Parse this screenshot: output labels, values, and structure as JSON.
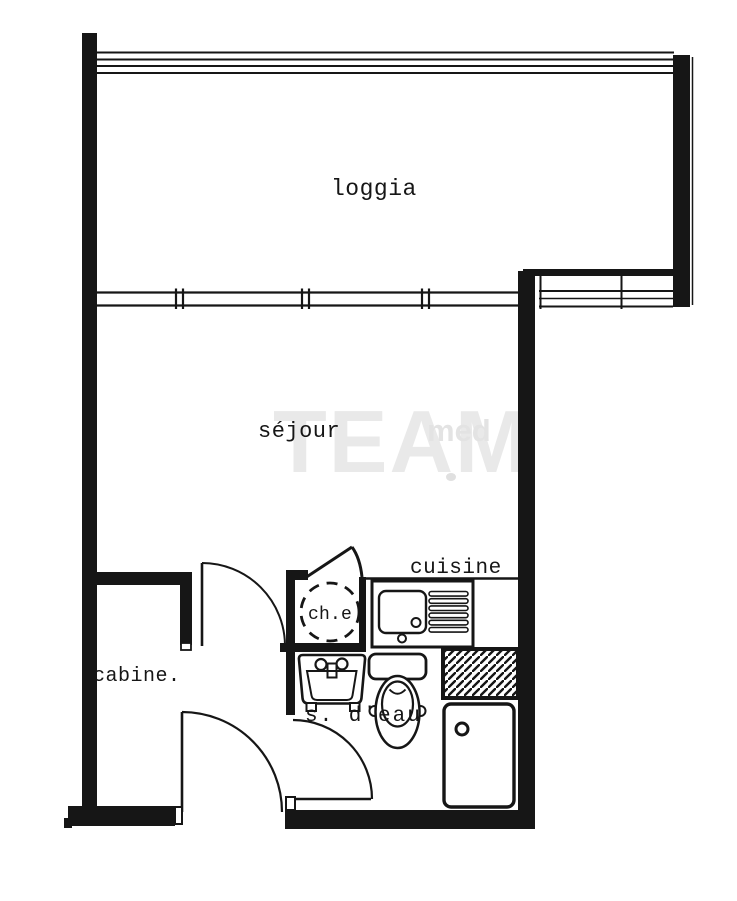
{
  "plan": {
    "rooms": {
      "loggia": "loggia",
      "sejour": "séjour",
      "cuisine": "cuisine",
      "cabine": "cabine.",
      "salle_eau": "s. d'eau",
      "chauffe_eau": "ch.e"
    },
    "watermark": {
      "main": "TEAM",
      "sub": "med"
    },
    "colors": {
      "ink": "#161616",
      "paper": "#ffffff",
      "watermark": "#e9e9e9"
    }
  }
}
